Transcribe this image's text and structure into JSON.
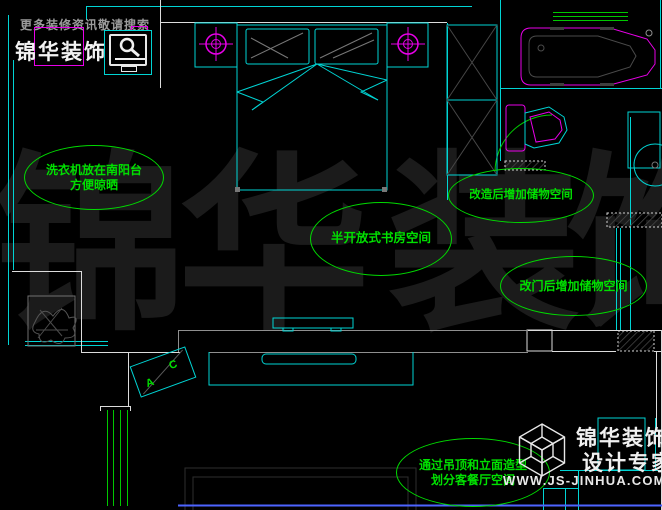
{
  "page": {
    "background": "#000000",
    "type": "CAD floor plan screenshot"
  },
  "colors": {
    "wall_cyan": "#00d4d4",
    "wall_white": "#dcdcdc",
    "wall_gray": "#8f8f8f",
    "annotation_green": "#00e000",
    "window_green": "#00c800",
    "fixture_magenta": "#e800e8",
    "watermark_gray": "#1b1b1b",
    "baseline_blue": "#4d64ff"
  },
  "top_logo": {
    "slogan": "更多装修资讯敬请搜索",
    "brand": "锦华装饰",
    "icon": "search-magnifier"
  },
  "bottom_logo": {
    "brand": "锦华装饰",
    "tagline": "设计专家",
    "url": "WWW.JS-JINHUA.COM",
    "icon": "wireframe-cube"
  },
  "watermark": {
    "text": "锦华装饰",
    "chars": [
      "锦",
      "华",
      "装",
      "饰"
    ]
  },
  "annotations": [
    {
      "id": "laundry",
      "line1": "洗衣机放在南阳台",
      "line2": "方便晾晒"
    },
    {
      "id": "study",
      "line1": "半开放式书房空间",
      "line2": ""
    },
    {
      "id": "storage-remodel",
      "line1": "改造后增加储物空间",
      "line2": ""
    },
    {
      "id": "storage-door",
      "line1": "改门后增加储物空间",
      "line2": ""
    },
    {
      "id": "living",
      "line1": "通过吊顶和立面造型",
      "line2": "划分客餐厅空间"
    }
  ],
  "ac_unit": {
    "letter_a": "A",
    "letter_c": "C"
  }
}
